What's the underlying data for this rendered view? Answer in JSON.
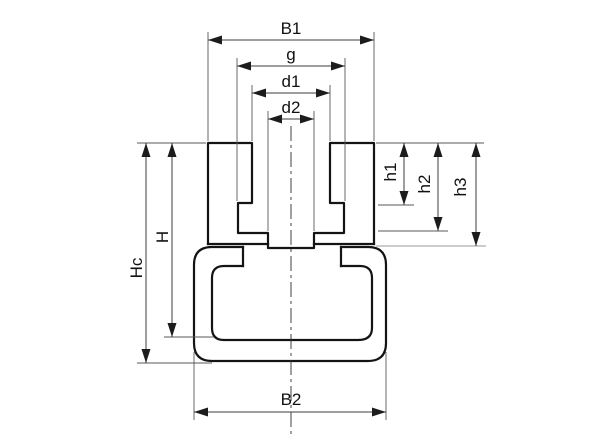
{
  "diagram": {
    "description": "Chain guide profile cross-section, dimensioned technical drawing",
    "labels": {
      "b1": "B1",
      "g": "g",
      "d1": "d1",
      "d2": "d2",
      "b2": "B2",
      "hc": "Hc",
      "h": "H",
      "h1": "h1",
      "h2": "h2",
      "h3": "h3"
    },
    "colors": {
      "outline": "#141414",
      "dimension": "#3d3d3d",
      "extension_gray": "#9a9a9a",
      "background": "#ffffff"
    }
  }
}
